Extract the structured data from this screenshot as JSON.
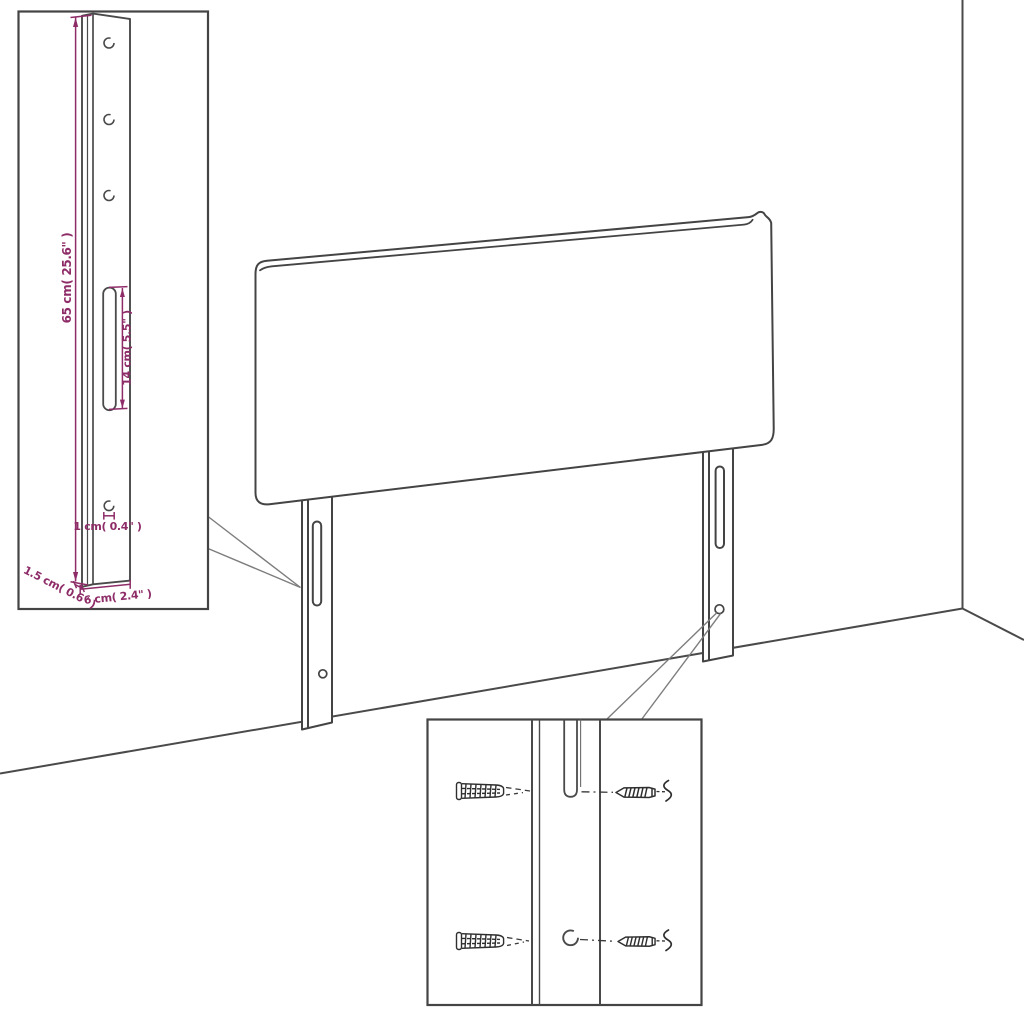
{
  "scene": {
    "background": "#ffffff",
    "outline_color": "#444444",
    "dimension_color": "#8E2C68",
    "callout_color": "#7d7d7d"
  },
  "headboard": {
    "legs_count": 2,
    "slots_per_leg": 1,
    "holes_per_leg": 1
  },
  "leg_detail_inset": {
    "top_holes_count": 3,
    "dimension_labels": {
      "total_height": "65 cm( 25.6\" )",
      "slot_length": "14 cm( 5.5\" )",
      "hole_diameter": "1 cm( 0.4\" )",
      "thickness": "1.5 cm( 0.6\" )",
      "width": "6 cm( 2.4\" )"
    }
  },
  "hardware_detail_inset": {
    "wall_plugs_count": 2,
    "screws_count": 2
  }
}
